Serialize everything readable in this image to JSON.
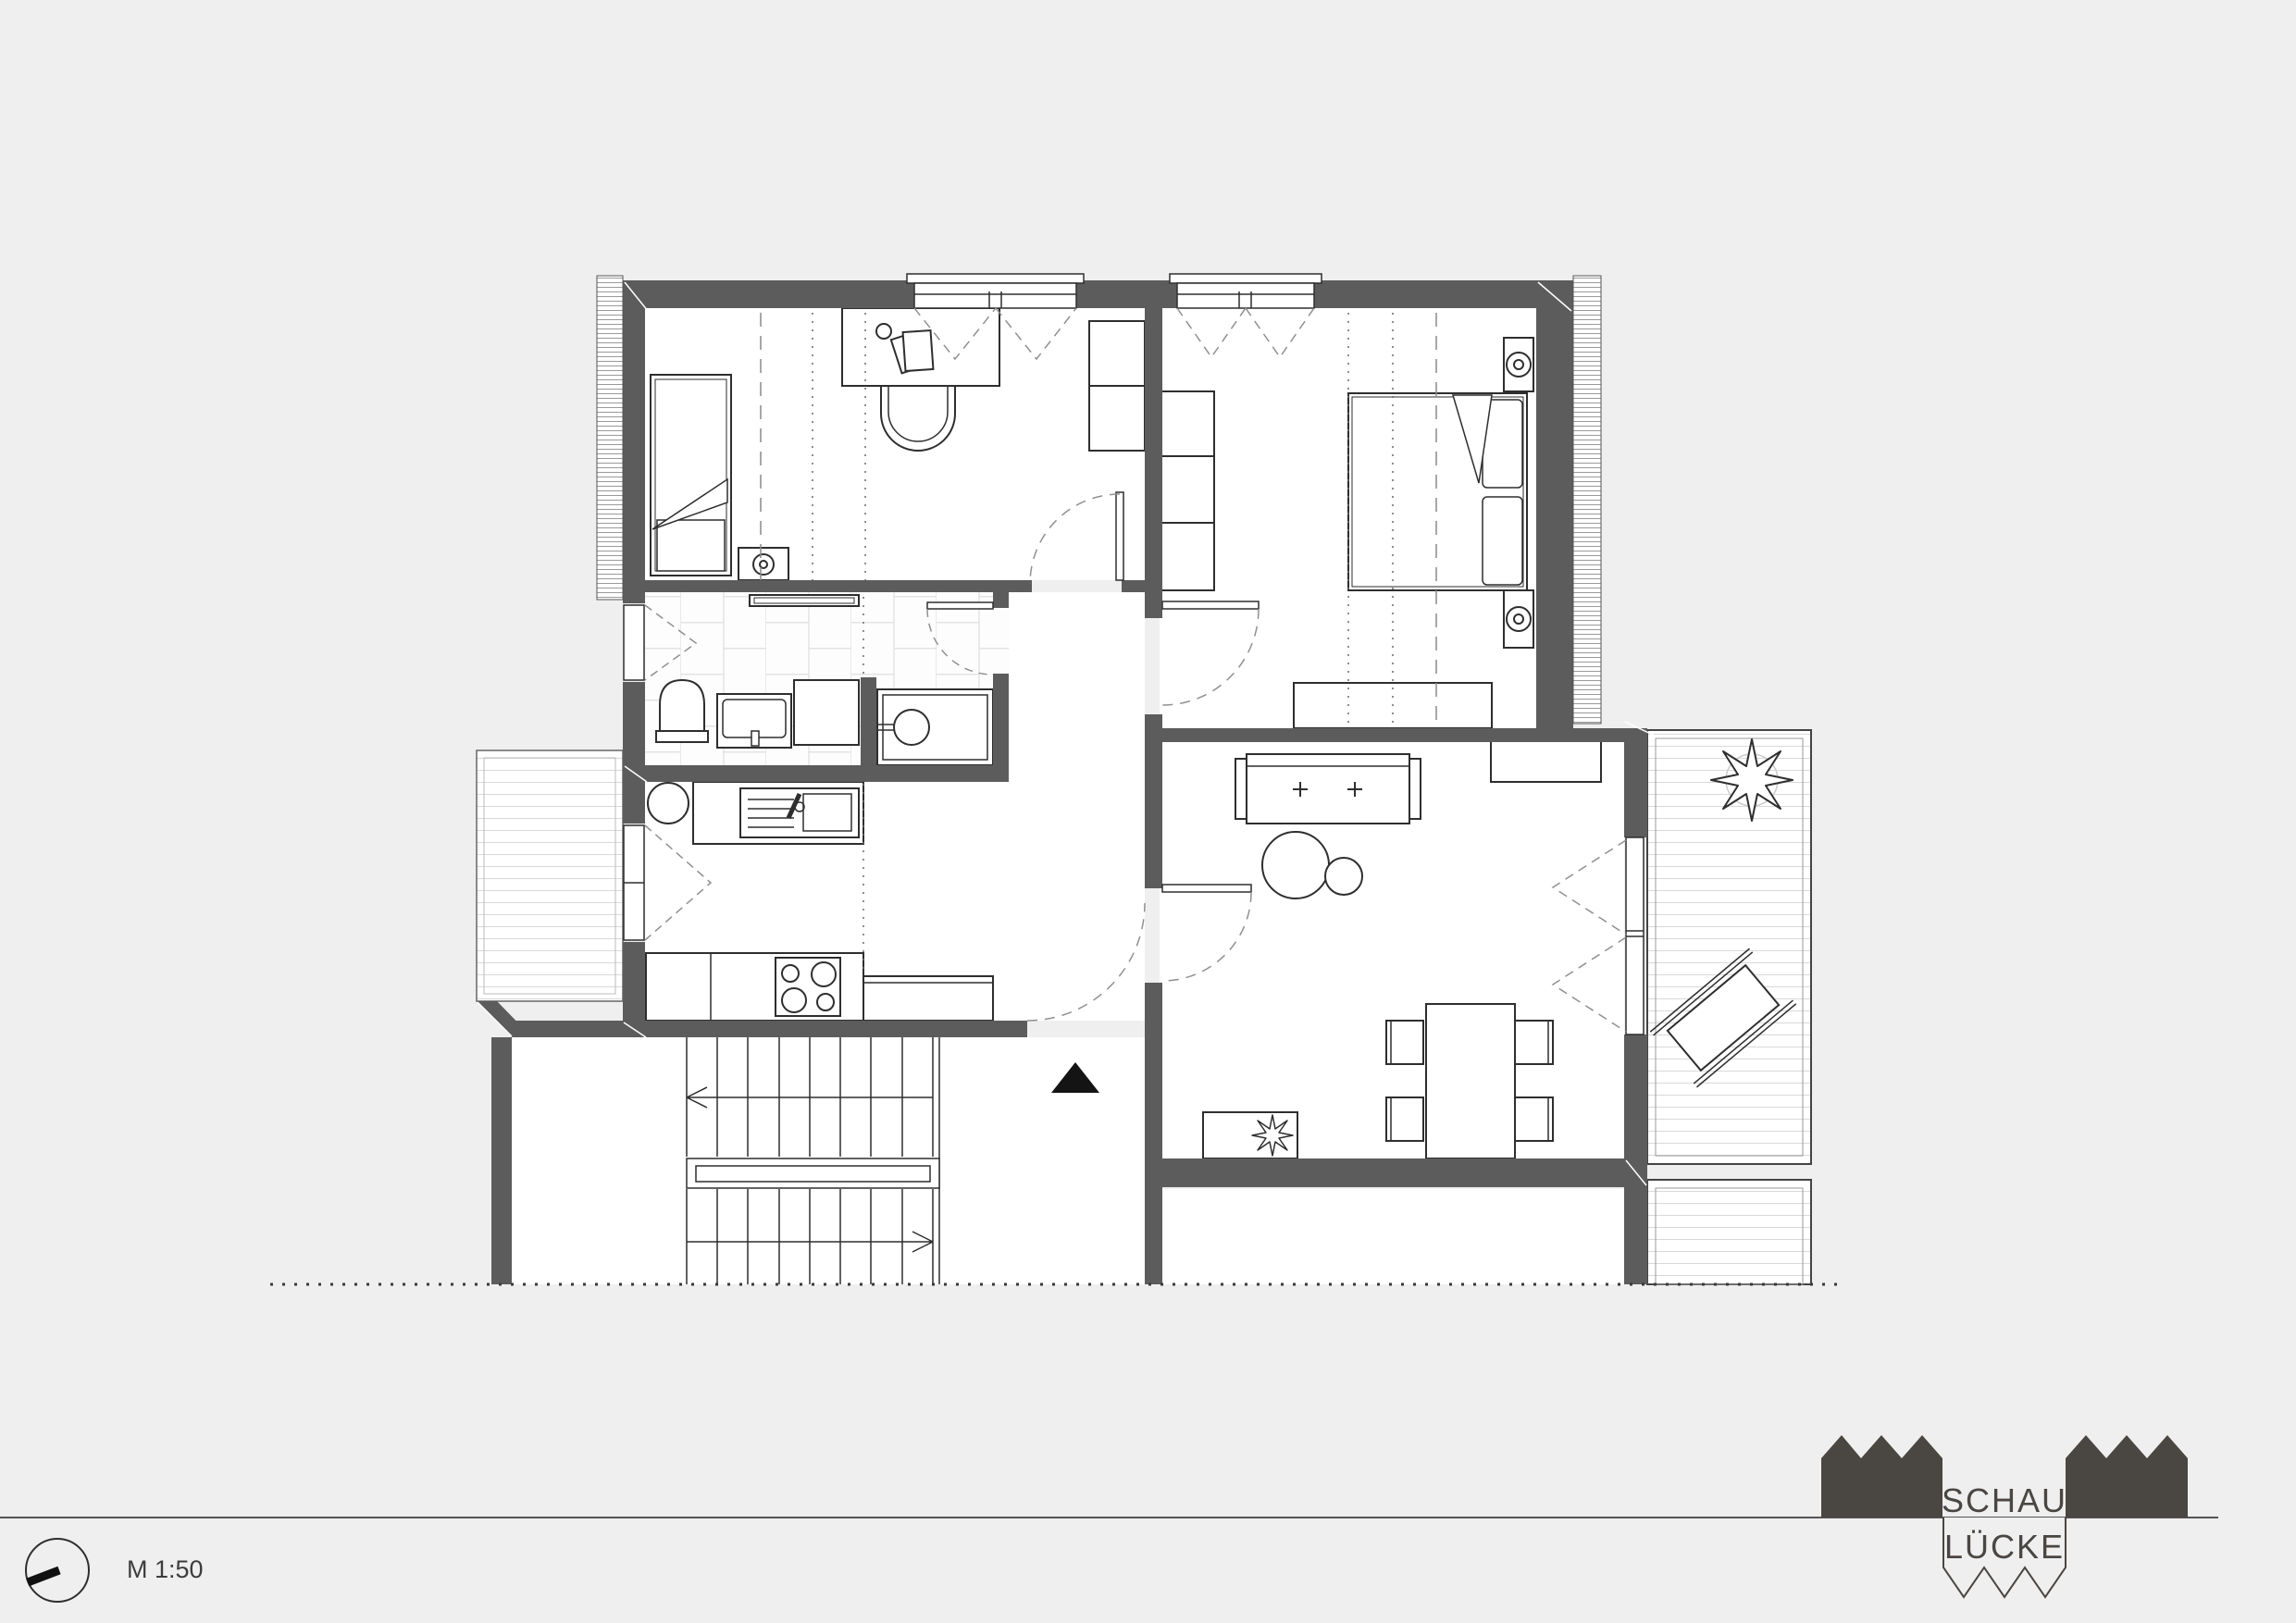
{
  "drawing": {
    "scale_label": "M 1:50",
    "logo": {
      "line1": "SCHAU",
      "line2": "LÜCKE"
    },
    "colors": {
      "background": "#efefef",
      "wall": "#5c5c5c",
      "line": "#2e2e2e",
      "dash": "#909090",
      "deck_line": "#d9d9d9",
      "tile_line": "#e3e3e3",
      "logo_dark": "#4a4642"
    },
    "icons": [
      "compass-icon",
      "entrance-arrow-icon",
      "factory-skyline-icon",
      "plant-icon"
    ]
  }
}
